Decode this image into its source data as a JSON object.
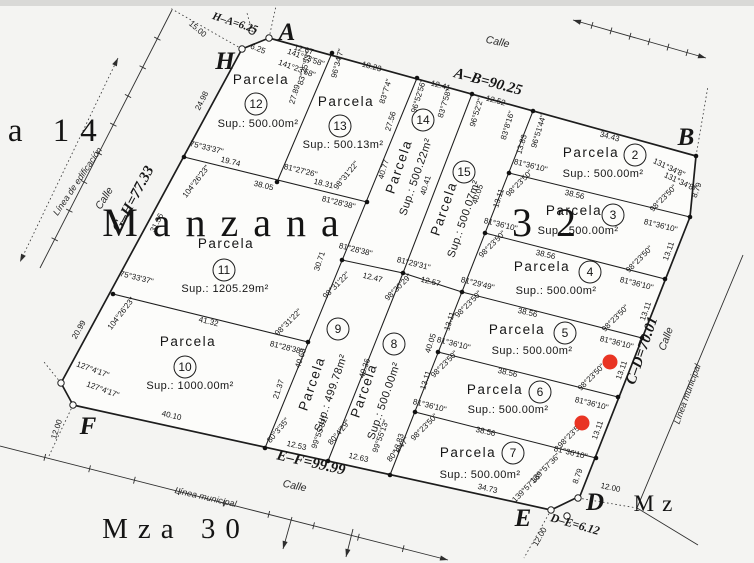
{
  "meta": {
    "title": "Manzana 32",
    "ink": "#1d1d1d",
    "red": "#e93423",
    "bg": "#f4f4f2",
    "topband": "#d9d9d7"
  },
  "outer_polygon": [
    [
      269,
      38
    ],
    [
      696,
      156
    ],
    [
      690,
      217
    ],
    [
      580,
      496
    ],
    [
      551,
      510
    ],
    [
      73,
      405
    ],
    [
      61,
      383
    ],
    [
      242,
      49
    ]
  ],
  "inner_lines": [
    [
      332,
      53,
      277,
      182
    ],
    [
      184,
      157,
      367,
      202
    ],
    [
      417,
      78,
      265,
      448
    ],
    [
      472,
      94,
      403,
      273
    ],
    [
      533,
      111,
      390,
      475
    ],
    [
      113,
      294,
      308,
      342
    ],
    [
      342,
      260,
      403,
      273
    ],
    [
      403,
      273,
      462,
      292
    ],
    [
      403,
      273,
      328,
      461
    ],
    [
      509,
      173,
      690,
      217
    ],
    [
      485,
      233,
      665,
      279
    ],
    [
      462,
      292,
      642,
      338
    ],
    [
      438,
      352,
      618,
      397
    ],
    [
      415,
      412,
      596,
      458
    ]
  ],
  "municipal_polyline": [
    [
      743,
      255
    ],
    [
      637,
      508
    ],
    [
      698,
      545
    ]
  ],
  "ticked_lines": [
    {
      "p": [
        172,
        10,
        40,
        268
      ],
      "ticks": 8,
      "a1": false,
      "a2": false,
      "dash": false
    },
    {
      "p": [
        573,
        20,
        706,
        58
      ],
      "ticks": 6,
      "a1": true,
      "a2": true,
      "dash": false
    },
    {
      "p": [
        0,
        446,
        448,
        560
      ],
      "ticks": 9,
      "a1": false,
      "a2": true,
      "dash": false
    },
    {
      "p": [
        118,
        58,
        20,
        262
      ],
      "ticks": 0,
      "a1": true,
      "a2": true,
      "dash": true
    },
    {
      "p": [
        292,
        517,
        283,
        549
      ],
      "ticks": 0,
      "a1": false,
      "a2": true,
      "dash": false
    },
    {
      "p": [
        353,
        529,
        346,
        557
      ],
      "ticks": 0,
      "a1": false,
      "a2": true,
      "dash": false
    }
  ],
  "dotted_lines": [
    [
      242,
      49,
      170,
      8
    ],
    [
      269,
      38,
      276,
      6
    ],
    [
      252,
      31,
      247,
      13
    ],
    [
      73,
      405,
      48,
      458
    ],
    [
      61,
      383,
      44,
      362
    ],
    [
      551,
      510,
      524,
      558
    ],
    [
      578,
      498,
      637,
      508
    ],
    [
      696,
      156,
      708,
      86
    ]
  ],
  "vertex_dots": [
    [
      332,
      53
    ],
    [
      417,
      78
    ],
    [
      472,
      94
    ],
    [
      533,
      111
    ],
    [
      696,
      156
    ],
    [
      690,
      217
    ],
    [
      665,
      279
    ],
    [
      642,
      338
    ],
    [
      618,
      397
    ],
    [
      596,
      458
    ],
    [
      184,
      157
    ],
    [
      277,
      182
    ],
    [
      367,
      202
    ],
    [
      342,
      260
    ],
    [
      403,
      273
    ],
    [
      462,
      292
    ],
    [
      485,
      233
    ],
    [
      509,
      173
    ],
    [
      438,
      352
    ],
    [
      415,
      412
    ],
    [
      390,
      475
    ],
    [
      328,
      461
    ],
    [
      265,
      448
    ],
    [
      308,
      342
    ],
    [
      113,
      294
    ]
  ],
  "monuments": [
    [
      242,
      49
    ],
    [
      269,
      38
    ],
    [
      252,
      31
    ],
    [
      61,
      383
    ],
    [
      73,
      405
    ],
    [
      578,
      498
    ],
    [
      551,
      510
    ],
    [
      567,
      516
    ]
  ],
  "red_markers": [
    {
      "x": 610,
      "y": 362
    },
    {
      "x": 582,
      "y": 423
    }
  ],
  "parcels": [
    {
      "num": "2",
      "name": "Parcela",
      "sup": "Sup.: 500.00m²",
      "name_pos": [
        591,
        157,
        0
      ],
      "circle": [
        635,
        155
      ],
      "sup_pos": [
        603,
        177,
        0
      ]
    },
    {
      "num": "3",
      "name": "Parcela",
      "sup": "Sup.: 500.00m²",
      "name_pos": [
        574,
        215,
        0
      ],
      "circle": [
        613,
        215
      ],
      "sup_pos": [
        578,
        234,
        0
      ]
    },
    {
      "num": "4",
      "name": "Parcela",
      "sup": "Sup.: 500.00m²",
      "name_pos": [
        542,
        271,
        0
      ],
      "circle": [
        590,
        272
      ],
      "sup_pos": [
        556,
        294,
        0
      ]
    },
    {
      "num": "5",
      "name": "Parcela",
      "sup": "Sup.: 500.00m²",
      "name_pos": [
        517,
        334,
        0
      ],
      "circle": [
        565,
        333
      ],
      "sup_pos": [
        532,
        354,
        0
      ]
    },
    {
      "num": "6",
      "name": "Parcela",
      "sup": "Sup.: 500.00m²",
      "name_pos": [
        495,
        394,
        0
      ],
      "circle": [
        540,
        392
      ],
      "sup_pos": [
        508,
        413,
        0
      ]
    },
    {
      "num": "7",
      "name": "Parcela",
      "sup": "Sup.: 500.00m²",
      "name_pos": [
        468,
        457,
        0
      ],
      "circle": [
        513,
        453
      ],
      "sup_pos": [
        480,
        478,
        0
      ]
    },
    {
      "num": "8",
      "name": "Parcela",
      "sup": "Sup.: 500.00m²",
      "name_pos": [
        368,
        392,
        -71
      ],
      "circle": [
        394,
        344
      ],
      "sup_pos": [
        387,
        402,
        -71
      ]
    },
    {
      "num": "9",
      "name": "Parcela",
      "sup": "Sup.: 499.78m²",
      "name_pos": [
        316,
        385,
        -71
      ],
      "circle": [
        338,
        329
      ],
      "sup_pos": [
        334,
        394,
        -71
      ]
    },
    {
      "num": "10",
      "name": "Parcela",
      "sup": "Sup.: 1000.00m²",
      "name_pos": [
        188,
        346,
        0
      ],
      "circle": [
        185,
        367
      ],
      "sup_pos": [
        190,
        389,
        0
      ]
    },
    {
      "num": "11",
      "name": "Parcela",
      "sup": "Sup.: 1205.29m²",
      "name_pos": [
        226,
        248,
        0
      ],
      "circle": [
        224,
        270
      ],
      "sup_pos": [
        225,
        292,
        0
      ]
    },
    {
      "num": "12",
      "name": "Parcela",
      "sup": "Sup.: 500.00m²",
      "name_pos": [
        261,
        84,
        0
      ],
      "circle": [
        256,
        104
      ],
      "sup_pos": [
        258,
        127,
        0
      ]
    },
    {
      "num": "13",
      "name": "Parcela",
      "sup": "Sup.: 500.13m²",
      "name_pos": [
        346,
        106,
        0
      ],
      "circle": [
        340,
        126
      ],
      "sup_pos": [
        343,
        148,
        0
      ]
    },
    {
      "num": "14",
      "name": "Parcela",
      "sup": "Sup.: 500.22m²",
      "name_pos": [
        403,
        168,
        -71
      ],
      "circle": [
        423,
        120
      ],
      "sup_pos": [
        419,
        178,
        -71
      ]
    },
    {
      "num": "15",
      "name": "Parcela",
      "sup": "Sup.: 500.07m²",
      "name_pos": [
        448,
        210,
        -71
      ],
      "circle": [
        464,
        172
      ],
      "sup_pos": [
        467,
        220,
        -71
      ]
    }
  ],
  "dim_labels": [
    {
      "t": "6.25",
      "x": 257,
      "y": 51,
      "r": 22
    },
    {
      "t": "12.67",
      "x": 303,
      "y": 52,
      "r": 15
    },
    {
      "t": "141°23'58\"",
      "x": 305,
      "y": 60,
      "r": 20
    },
    {
      "t": "141°23'58\"",
      "x": 296,
      "y": 71,
      "r": 20
    },
    {
      "t": "18.23",
      "x": 371,
      "y": 69,
      "r": 15
    },
    {
      "t": "83°25'53\"",
      "x": 307,
      "y": 69,
      "r": -75
    },
    {
      "t": "96°34'7\"",
      "x": 340,
      "y": 64,
      "r": -75
    },
    {
      "t": "27.89",
      "x": 297,
      "y": 95,
      "r": -73
    },
    {
      "t": "12.41",
      "x": 440,
      "y": 88,
      "r": 15
    },
    {
      "t": "83°7'4\"",
      "x": 388,
      "y": 92,
      "r": -73
    },
    {
      "t": "96°52'56\"",
      "x": 421,
      "y": 97,
      "r": -73
    },
    {
      "t": "27.56",
      "x": 393,
      "y": 122,
      "r": -73
    },
    {
      "t": "12.52",
      "x": 495,
      "y": 103,
      "r": 15
    },
    {
      "t": "83°7'58\"",
      "x": 447,
      "y": 104,
      "r": -73
    },
    {
      "t": "96°52'2\"",
      "x": 479,
      "y": 113,
      "r": -73
    },
    {
      "t": "40.77",
      "x": 386,
      "y": 170,
      "r": -73
    },
    {
      "t": "40.41",
      "x": 428,
      "y": 186,
      "r": -73
    },
    {
      "t": "34.43",
      "x": 609,
      "y": 139,
      "r": 15
    },
    {
      "t": "83°8'16\"",
      "x": 510,
      "y": 126,
      "r": -73
    },
    {
      "t": "96°51'44\"",
      "x": 541,
      "y": 132,
      "r": -73
    },
    {
      "t": "13.83",
      "x": 524,
      "y": 145,
      "r": -73
    },
    {
      "t": "131°34'8\"",
      "x": 668,
      "y": 170,
      "r": 25
    },
    {
      "t": "131°34'8\"",
      "x": 679,
      "y": 184,
      "r": 25
    },
    {
      "t": "8.79",
      "x": 699,
      "y": 191,
      "r": -70
    },
    {
      "t": "40.05",
      "x": 480,
      "y": 195,
      "r": -72
    },
    {
      "t": "81°36'10\"",
      "x": 530,
      "y": 168,
      "r": 14
    },
    {
      "t": "98°23'50\"",
      "x": 521,
      "y": 185,
      "r": -45
    },
    {
      "t": "38.56",
      "x": 574,
      "y": 197,
      "r": 13
    },
    {
      "t": "98°23'50\"",
      "x": 665,
      "y": 200,
      "r": -45
    },
    {
      "t": "81°36'10\"",
      "x": 660,
      "y": 228,
      "r": 14
    },
    {
      "t": "13.11",
      "x": 671,
      "y": 252,
      "r": -70
    },
    {
      "t": "13.11",
      "x": 501,
      "y": 199,
      "r": -72
    },
    {
      "t": "81°36'10\"",
      "x": 500,
      "y": 227,
      "r": 14
    },
    {
      "t": "98°23'50\"",
      "x": 494,
      "y": 246,
      "r": -45
    },
    {
      "t": "38.56",
      "x": 545,
      "y": 257,
      "r": 13
    },
    {
      "t": "98°23'50\"",
      "x": 641,
      "y": 261,
      "r": -45
    },
    {
      "t": "81°36'10\"",
      "x": 636,
      "y": 286,
      "r": 14
    },
    {
      "t": "13.11",
      "x": 648,
      "y": 312,
      "r": -70
    },
    {
      "t": "81°29'49\"",
      "x": 477,
      "y": 286,
      "r": 14
    },
    {
      "t": "98°23'50\"",
      "x": 470,
      "y": 306,
      "r": -45
    },
    {
      "t": "38.56",
      "x": 527,
      "y": 315,
      "r": 13
    },
    {
      "t": "98°23'50\"",
      "x": 617,
      "y": 320,
      "r": -45
    },
    {
      "t": "81°36'10\"",
      "x": 616,
      "y": 345,
      "r": 14
    },
    {
      "t": "13.11",
      "x": 452,
      "y": 322,
      "r": -72
    },
    {
      "t": "13.11",
      "x": 624,
      "y": 371,
      "r": -70
    },
    {
      "t": "81°36'10\"",
      "x": 453,
      "y": 346,
      "r": 14
    },
    {
      "t": "98°23'50\"",
      "x": 446,
      "y": 366,
      "r": -45
    },
    {
      "t": "38.56",
      "x": 507,
      "y": 375,
      "r": 13
    },
    {
      "t": "98°23'50\"",
      "x": 593,
      "y": 379,
      "r": -45
    },
    {
      "t": "81°36'10\"",
      "x": 591,
      "y": 406,
      "r": 14
    },
    {
      "t": "13.11",
      "x": 428,
      "y": 381,
      "r": -72
    },
    {
      "t": "13.11",
      "x": 600,
      "y": 431,
      "r": -70
    },
    {
      "t": "81°36'10\"",
      "x": 429,
      "y": 408,
      "r": 14
    },
    {
      "t": "98°23'50\"",
      "x": 426,
      "y": 429,
      "r": -45
    },
    {
      "t": "38.56",
      "x": 485,
      "y": 434,
      "r": 13
    },
    {
      "t": "98°23'50\"",
      "x": 573,
      "y": 436,
      "r": -45
    },
    {
      "t": "81°36'10\"",
      "x": 570,
      "y": 455,
      "r": 14
    },
    {
      "t": "13.83",
      "x": 401,
      "y": 444,
      "r": -73
    },
    {
      "t": "8.79",
      "x": 580,
      "y": 477,
      "r": -70
    },
    {
      "t": "139°57'36\"",
      "x": 547,
      "y": 470,
      "r": -45
    },
    {
      "t": "139°57'36\"",
      "x": 529,
      "y": 489,
      "r": -45
    },
    {
      "t": "34.73",
      "x": 487,
      "y": 491,
      "r": 13
    },
    {
      "t": "12.63",
      "x": 358,
      "y": 460,
      "r": 13
    },
    {
      "t": "12.53",
      "x": 296,
      "y": 448,
      "r": 13
    },
    {
      "t": "80°3'35\"",
      "x": 280,
      "y": 432,
      "r": -50
    },
    {
      "t": "99°55'31\"",
      "x": 322,
      "y": 433,
      "r": -70
    },
    {
      "t": "80°4'29\"",
      "x": 341,
      "y": 434,
      "r": -50
    },
    {
      "t": "99°55'13\"",
      "x": 383,
      "y": 437,
      "r": -70
    },
    {
      "t": "80°4'47\"",
      "x": 400,
      "y": 451,
      "r": -50
    },
    {
      "t": "40.10",
      "x": 171,
      "y": 418,
      "r": 13
    },
    {
      "t": "40.68",
      "x": 303,
      "y": 359,
      "r": -72
    },
    {
      "t": "40.36",
      "x": 367,
      "y": 369,
      "r": -72
    },
    {
      "t": "40.05",
      "x": 433,
      "y": 344,
      "r": -72
    },
    {
      "t": "12.47",
      "x": 372,
      "y": 280,
      "r": 14
    },
    {
      "t": "12.57",
      "x": 430,
      "y": 284,
      "r": 14
    },
    {
      "t": "81°29'31\"",
      "x": 413,
      "y": 266,
      "r": 14
    },
    {
      "t": "98°30'29\"",
      "x": 400,
      "y": 289,
      "r": -45
    },
    {
      "t": "81°28'38\"",
      "x": 355,
      "y": 252,
      "r": 14
    },
    {
      "t": "98°31'22\"",
      "x": 338,
      "y": 287,
      "r": -45
    },
    {
      "t": "30.71",
      "x": 322,
      "y": 262,
      "r": -72
    },
    {
      "t": "98°31'22\"",
      "x": 348,
      "y": 177,
      "r": -50
    },
    {
      "t": "81°28'38\"",
      "x": 338,
      "y": 205,
      "r": 14
    },
    {
      "t": "81°27'26\"",
      "x": 300,
      "y": 173,
      "r": 14
    },
    {
      "t": "18.31",
      "x": 323,
      "y": 186,
      "r": 14
    },
    {
      "t": "38.05",
      "x": 263,
      "y": 188,
      "r": 14
    },
    {
      "t": "19.74",
      "x": 230,
      "y": 164,
      "r": 14
    },
    {
      "t": "75°33'37\"",
      "x": 206,
      "y": 150,
      "r": 14
    },
    {
      "t": "104°26'23\"",
      "x": 198,
      "y": 183,
      "r": -52
    },
    {
      "t": "24.98",
      "x": 204,
      "y": 102,
      "r": -63
    },
    {
      "t": "31.36",
      "x": 159,
      "y": 224,
      "r": -63
    },
    {
      "t": "75°33'37\"",
      "x": 136,
      "y": 280,
      "r": 14
    },
    {
      "t": "104°26'23\"",
      "x": 123,
      "y": 315,
      "r": -52
    },
    {
      "t": "20.99",
      "x": 81,
      "y": 331,
      "r": -60
    },
    {
      "t": "41.32",
      "x": 208,
      "y": 324,
      "r": 14
    },
    {
      "t": "21.37",
      "x": 281,
      "y": 390,
      "r": -72
    },
    {
      "t": "98°31'22\"",
      "x": 290,
      "y": 324,
      "r": -45
    },
    {
      "t": "81°28'38\"",
      "x": 286,
      "y": 350,
      "r": 14
    },
    {
      "t": "127°4'17\"",
      "x": 92,
      "y": 372,
      "r": 20
    },
    {
      "t": "127°4'17\"",
      "x": 102,
      "y": 392,
      "r": 20
    },
    {
      "t": "15.00",
      "x": 196,
      "y": 31,
      "r": 40
    },
    {
      "t": "12.00",
      "x": 610,
      "y": 490,
      "r": 12
    },
    {
      "t": "12.00",
      "x": 542,
      "y": 538,
      "r": -60
    },
    {
      "t": "12.00",
      "x": 59,
      "y": 430,
      "r": -72
    }
  ],
  "edge_labels": [
    {
      "t": "A–B=90.25",
      "x": 487,
      "y": 86,
      "r": 15,
      "s": 15
    },
    {
      "t": "G–H=77.33",
      "x": 137,
      "y": 201,
      "r": -62,
      "s": 15
    },
    {
      "t": "C–D=70.01",
      "x": 646,
      "y": 352,
      "r": -71,
      "s": 15
    },
    {
      "t": "E–F=99.99",
      "x": 310,
      "y": 467,
      "r": 13,
      "s": 15
    },
    {
      "t": "D–E=6.12",
      "x": 574,
      "y": 528,
      "r": 16,
      "s": 12
    },
    {
      "t": "H–A=6.25",
      "x": 234,
      "y": 26,
      "r": 18,
      "s": 11
    }
  ],
  "corner_letters": [
    {
      "t": "A",
      "x": 287,
      "y": 40
    },
    {
      "t": "B",
      "x": 686,
      "y": 145
    },
    {
      "t": "H",
      "x": 225,
      "y": 69
    },
    {
      "t": "F",
      "x": 88,
      "y": 434
    },
    {
      "t": "E",
      "x": 523,
      "y": 526
    },
    {
      "t": "D",
      "x": 595,
      "y": 510
    }
  ],
  "street_labels": [
    {
      "t": "Calle",
      "x": 497,
      "y": 45,
      "r": 12,
      "c": "street"
    },
    {
      "t": "Calle",
      "x": 107,
      "y": 200,
      "r": -58,
      "c": "street"
    },
    {
      "t": "Calle",
      "x": 294,
      "y": 489,
      "r": 12,
      "c": "street"
    },
    {
      "t": "Calle",
      "x": 669,
      "y": 340,
      "r": -70,
      "c": "street"
    },
    {
      "t": "Línea de edificación",
      "x": 80,
      "y": 183,
      "r": -56,
      "c": "lbl2"
    },
    {
      "t": "Línea municipal",
      "x": 205,
      "y": 500,
      "r": 13,
      "c": "lbl2"
    },
    {
      "t": "Línea municipal",
      "x": 690,
      "y": 395,
      "r": -70,
      "c": "lbl2"
    }
  ],
  "big_texts": [
    {
      "t": "Manzana",
      "x": 228,
      "y": 236,
      "size": 40,
      "spacing": 15
    },
    {
      "t": "32",
      "x": 556,
      "y": 236,
      "size": 40,
      "spacing": 24
    },
    {
      "t": "za 14",
      "x": 45,
      "y": 141,
      "size": 33,
      "spacing": 11
    },
    {
      "t": "Mza 30",
      "x": 176,
      "y": 538,
      "size": 29,
      "spacing": 10
    },
    {
      "t": "Mz",
      "x": 657,
      "y": 511,
      "size": 23,
      "spacing": 8
    }
  ]
}
